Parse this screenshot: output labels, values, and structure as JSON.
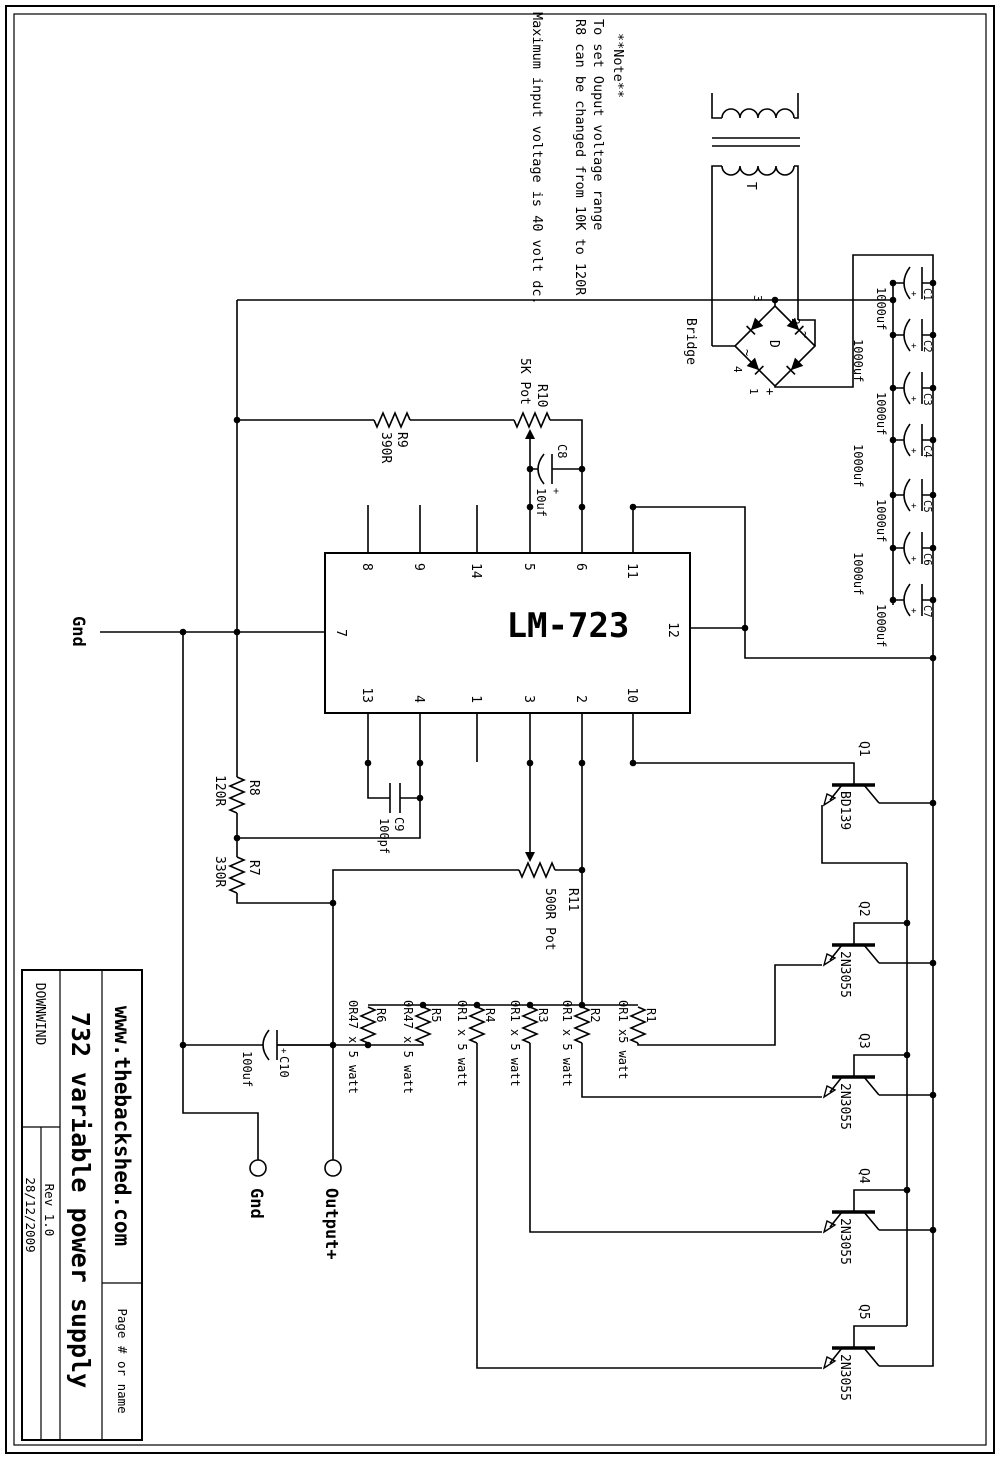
{
  "sheet": {
    "site": "www.thebackshed.com",
    "title": "732 variable power supply",
    "project": "DOWNWIND",
    "rev": "Rev 1.0",
    "date": "28/12/2009",
    "page": "Page # or name"
  },
  "notes": {
    "line1": "**Note**",
    "line2": "To set Ouput voltage range",
    "line3": "R8 can be changed from 10K to 120R",
    "line4": "Maximum input voltage is 40 volt dc."
  },
  "ic": {
    "label": "LM-723",
    "pins_left": [
      "11",
      "6",
      "5",
      "14",
      "9",
      "8"
    ],
    "pins_right": [
      "10",
      "2",
      "3",
      "1",
      "4",
      "13"
    ],
    "pin_top": "12",
    "pin_bottom": "7"
  },
  "transformer": {
    "label": "T"
  },
  "bridge": {
    "label": "Bridge",
    "center": "D",
    "pin1": "1",
    "pin2": "2",
    "pin3": "3",
    "pin4": "4",
    "plus": "+",
    "ac1": "~",
    "ac2": "~"
  },
  "filter_caps": [
    {
      "name": "C1",
      "value": "1000uf",
      "polarity": "+"
    },
    {
      "name": "C2",
      "value": "1000uf",
      "polarity": "+"
    },
    {
      "name": "C3",
      "value": "1000uf",
      "polarity": "+"
    },
    {
      "name": "C4",
      "value": "1000uf",
      "polarity": "+"
    },
    {
      "name": "C5",
      "value": "1000uf",
      "polarity": "+"
    },
    {
      "name": "C6",
      "value": "1000uf",
      "polarity": "+"
    },
    {
      "name": "C7",
      "value": "1000uf",
      "polarity": "+"
    }
  ],
  "caps": {
    "c8": {
      "name": "C8",
      "value": "10uf",
      "polarity": "+"
    },
    "c9": {
      "name": "C9",
      "value": "100pf"
    },
    "c10": {
      "name": "C10",
      "value": "100uf",
      "polarity": "+"
    }
  },
  "resistors": {
    "r7": {
      "name": "R7",
      "value": "330R"
    },
    "r8": {
      "name": "R8",
      "value": "120R"
    },
    "r9": {
      "name": "R9",
      "value": "390R"
    },
    "r10": {
      "name": "R10",
      "value": "5K Pot"
    },
    "r11": {
      "name": "R11",
      "value": "500R Pot"
    }
  },
  "emitter_resistors": [
    {
      "name": "R1",
      "value": "0R1 x5 watt"
    },
    {
      "name": "R2",
      "value": "0R1 x 5 watt"
    },
    {
      "name": "R3",
      "value": "0R1 x 5 watt"
    },
    {
      "name": "R4",
      "value": "0R1 x 5 watt"
    },
    {
      "name": "R5",
      "value": "0R47 x 5 watt"
    },
    {
      "name": "R6",
      "value": "0R47 x 5 watt"
    }
  ],
  "transistors": [
    {
      "name": "Q1",
      "value": "BD139"
    },
    {
      "name": "Q2",
      "value": "2N3055"
    },
    {
      "name": "Q3",
      "value": "2N3055"
    },
    {
      "name": "Q4",
      "value": "2N3055"
    },
    {
      "name": "Q5",
      "value": "2N3055"
    }
  ],
  "terminals": {
    "gnd_wire": "Gnd",
    "gnd_terminal": "Gnd",
    "output": "Output+"
  },
  "colors": {
    "ink": "#000000",
    "paper": "#ffffff"
  }
}
